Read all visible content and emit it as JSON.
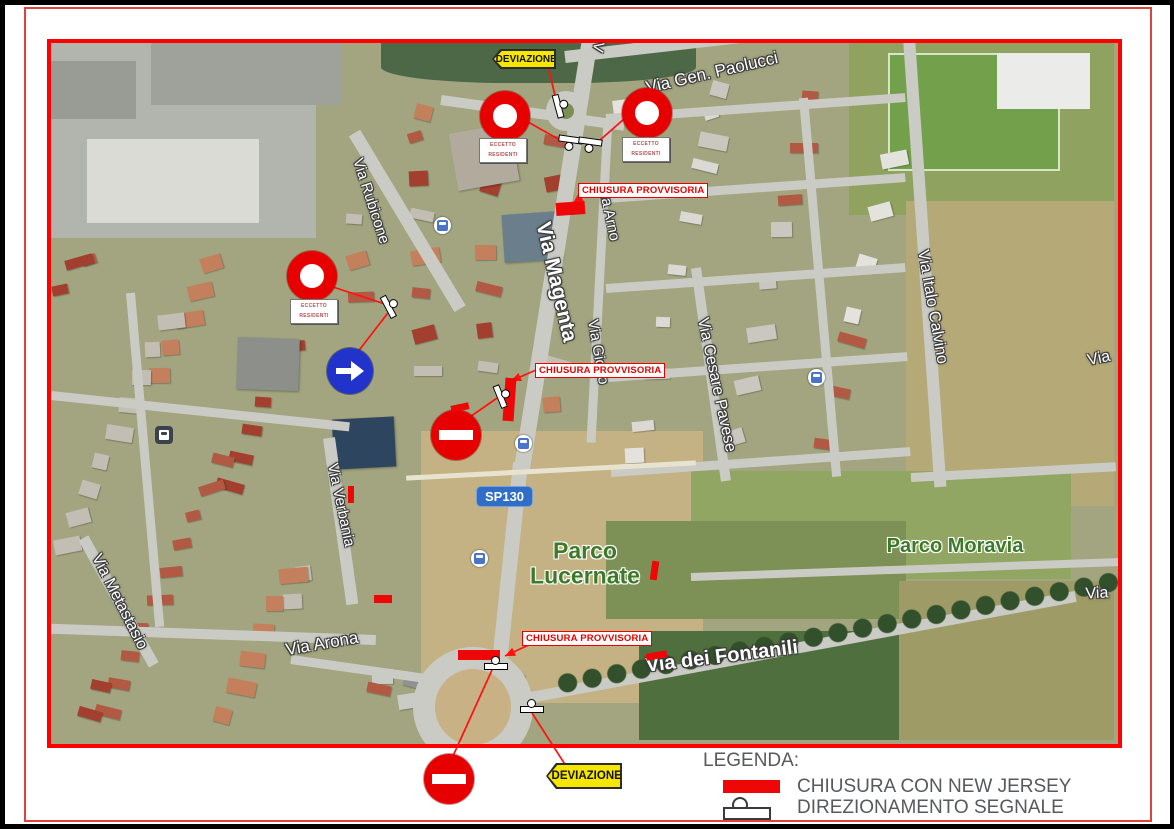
{
  "frame": {
    "map_border": "#ff0000",
    "page_frame": "#e0433c",
    "page_edge": "#000000"
  },
  "colors": {
    "closure_red": "#ee0707",
    "detour_yellow": "#f7e700",
    "mandatory_blue": "#2233cc",
    "no_entry_red": "#e60000",
    "shield_blue": "#2f6dc6",
    "legend_text": "#58595b",
    "park_green": "#3c7a28"
  },
  "legend": {
    "title": "LEGENDA:",
    "items": [
      {
        "symbol": "new-jersey-bar",
        "label": "CHIUSURA CON NEW JERSEY"
      },
      {
        "symbol": "direction-signal",
        "label": "DIREZIONAMENTO SEGNALE"
      }
    ]
  },
  "map": {
    "route_shield": {
      "text": "SP130",
      "x": 477,
      "y": 487
    },
    "street_labels": [
      {
        "text": "Via Gen. Paolucci",
        "x": 712,
        "y": 73,
        "rot": -13,
        "size": 17
      },
      {
        "text": "V",
        "x": 598,
        "y": 47,
        "rot": 100,
        "size": 15
      },
      {
        "text": "Via Rubicone",
        "x": 371,
        "y": 201,
        "rot": 72,
        "size": 15
      },
      {
        "text": "Via Arno",
        "x": 609,
        "y": 213,
        "rot": 78,
        "size": 15
      },
      {
        "text": "Via Magenta",
        "x": 556,
        "y": 282,
        "rot": 77,
        "size": 21,
        "bold": true
      },
      {
        "text": "Via Giotto",
        "x": 598,
        "y": 352,
        "rot": 80,
        "size": 15
      },
      {
        "text": "Via Cesare Pavese",
        "x": 716,
        "y": 385,
        "rot": 78,
        "size": 16
      },
      {
        "text": "Via Italo Calvino",
        "x": 932,
        "y": 307,
        "rot": 80,
        "size": 16
      },
      {
        "text": "Via Verbania",
        "x": 341,
        "y": 505,
        "rot": 78,
        "size": 15
      },
      {
        "text": "Via Metastasio",
        "x": 119,
        "y": 602,
        "rot": 63,
        "size": 16
      },
      {
        "text": "Via Arona",
        "x": 322,
        "y": 644,
        "rot": -10,
        "size": 17
      },
      {
        "text": "Via dei Fontanili",
        "x": 722,
        "y": 657,
        "rot": -7,
        "size": 20,
        "bold": true
      },
      {
        "text": "Via",
        "x": 1099,
        "y": 359,
        "rot": -12,
        "size": 16
      },
      {
        "text": "Via",
        "x": 1097,
        "y": 594,
        "rot": -3,
        "size": 16
      }
    ],
    "park_labels": [
      {
        "text": "Parco\nLucernate",
        "x": 585,
        "y": 564,
        "size": 23
      },
      {
        "text": "Parco Moravia",
        "x": 955,
        "y": 546,
        "size": 20
      }
    ],
    "closure_label_text": "CHIUSURA PROVVISORIA",
    "closure_labels": [
      {
        "x": 578,
        "y": 183
      },
      {
        "x": 535,
        "y": 363
      },
      {
        "x": 522,
        "y": 631
      }
    ],
    "detour_text": "DEVIAZIONE",
    "detour_signs": [
      {
        "x": 492,
        "y": 49,
        "w": 64,
        "h": 20,
        "font": 10
      },
      {
        "x": 546,
        "y": 763,
        "w": 76,
        "h": 26,
        "font": 11.5
      }
    ],
    "no_entry_signs": [
      {
        "x": 505,
        "y": 116
      },
      {
        "x": 647,
        "y": 113
      },
      {
        "x": 312,
        "y": 276
      }
    ],
    "senso_vietato_signs": [
      {
        "x": 456,
        "y": 435
      },
      {
        "x": 449,
        "y": 779
      }
    ],
    "exception_text": "ECCETTO\nRESIDENTI",
    "exception_labels": [
      {
        "x": 503,
        "y": 150
      },
      {
        "x": 646,
        "y": 149
      },
      {
        "x": 314,
        "y": 311
      }
    ],
    "mandatory_direction_sign": {
      "x": 350,
      "y": 371
    },
    "barriers": [
      {
        "x": 556,
        "y": 202,
        "w": 29,
        "h": 13,
        "r": -4
      },
      {
        "x": 504,
        "y": 378,
        "w": 11,
        "h": 43,
        "r": 4
      },
      {
        "x": 451,
        "y": 404,
        "w": 18,
        "h": 7,
        "r": -12
      },
      {
        "x": 348,
        "y": 486,
        "w": 6,
        "h": 17,
        "r": 0
      },
      {
        "x": 374,
        "y": 595,
        "w": 18,
        "h": 8,
        "r": 0
      },
      {
        "x": 458,
        "y": 650,
        "w": 42,
        "h": 10,
        "r": 0
      },
      {
        "x": 646,
        "y": 652,
        "w": 21,
        "h": 7,
        "r": -10
      },
      {
        "x": 651,
        "y": 561,
        "w": 7,
        "h": 19,
        "r": 8
      }
    ],
    "direction_symbols": [
      {
        "x": 561,
        "y": 106,
        "r": 75,
        "ball": "above"
      },
      {
        "x": 570,
        "y": 143,
        "r": 8,
        "ball": "below"
      },
      {
        "x": 590,
        "y": 145,
        "r": 8,
        "ball": "below"
      },
      {
        "x": 391,
        "y": 306,
        "r": 62,
        "ball": "above"
      },
      {
        "x": 503,
        "y": 396,
        "r": 68,
        "ball": "above"
      },
      {
        "x": 496,
        "y": 664,
        "r": 0,
        "ball": "above"
      },
      {
        "x": 532,
        "y": 707,
        "r": 0,
        "ball": "above"
      }
    ],
    "bus_stops": [
      {
        "x": 442,
        "y": 225,
        "variant": "light"
      },
      {
        "x": 816,
        "y": 377,
        "variant": "light"
      },
      {
        "x": 523,
        "y": 443,
        "variant": "light"
      },
      {
        "x": 479,
        "y": 558,
        "variant": "light"
      },
      {
        "x": 163,
        "y": 434,
        "variant": "dark"
      }
    ],
    "leader_lines": [
      {
        "x1": 548,
        "y1": 66,
        "x2": 557,
        "y2": 104
      },
      {
        "x1": 528,
        "y1": 122,
        "x2": 560,
        "y2": 140
      },
      {
        "x1": 624,
        "y1": 119,
        "x2": 599,
        "y2": 141
      },
      {
        "x1": 333,
        "y1": 287,
        "x2": 388,
        "y2": 305
      },
      {
        "x1": 357,
        "y1": 353,
        "x2": 391,
        "y2": 309
      },
      {
        "x1": 584,
        "y1": 195,
        "x2": 573,
        "y2": 203,
        "arrow": true
      },
      {
        "x1": 536,
        "y1": 370,
        "x2": 511,
        "y2": 381,
        "arrow": true
      },
      {
        "x1": 467,
        "y1": 419,
        "x2": 500,
        "y2": 396
      },
      {
        "x1": 533,
        "y1": 643,
        "x2": 505,
        "y2": 656,
        "arrow": true
      },
      {
        "x1": 492,
        "y1": 670,
        "x2": 453,
        "y2": 756
      },
      {
        "x1": 532,
        "y1": 713,
        "x2": 566,
        "y2": 766
      }
    ]
  }
}
